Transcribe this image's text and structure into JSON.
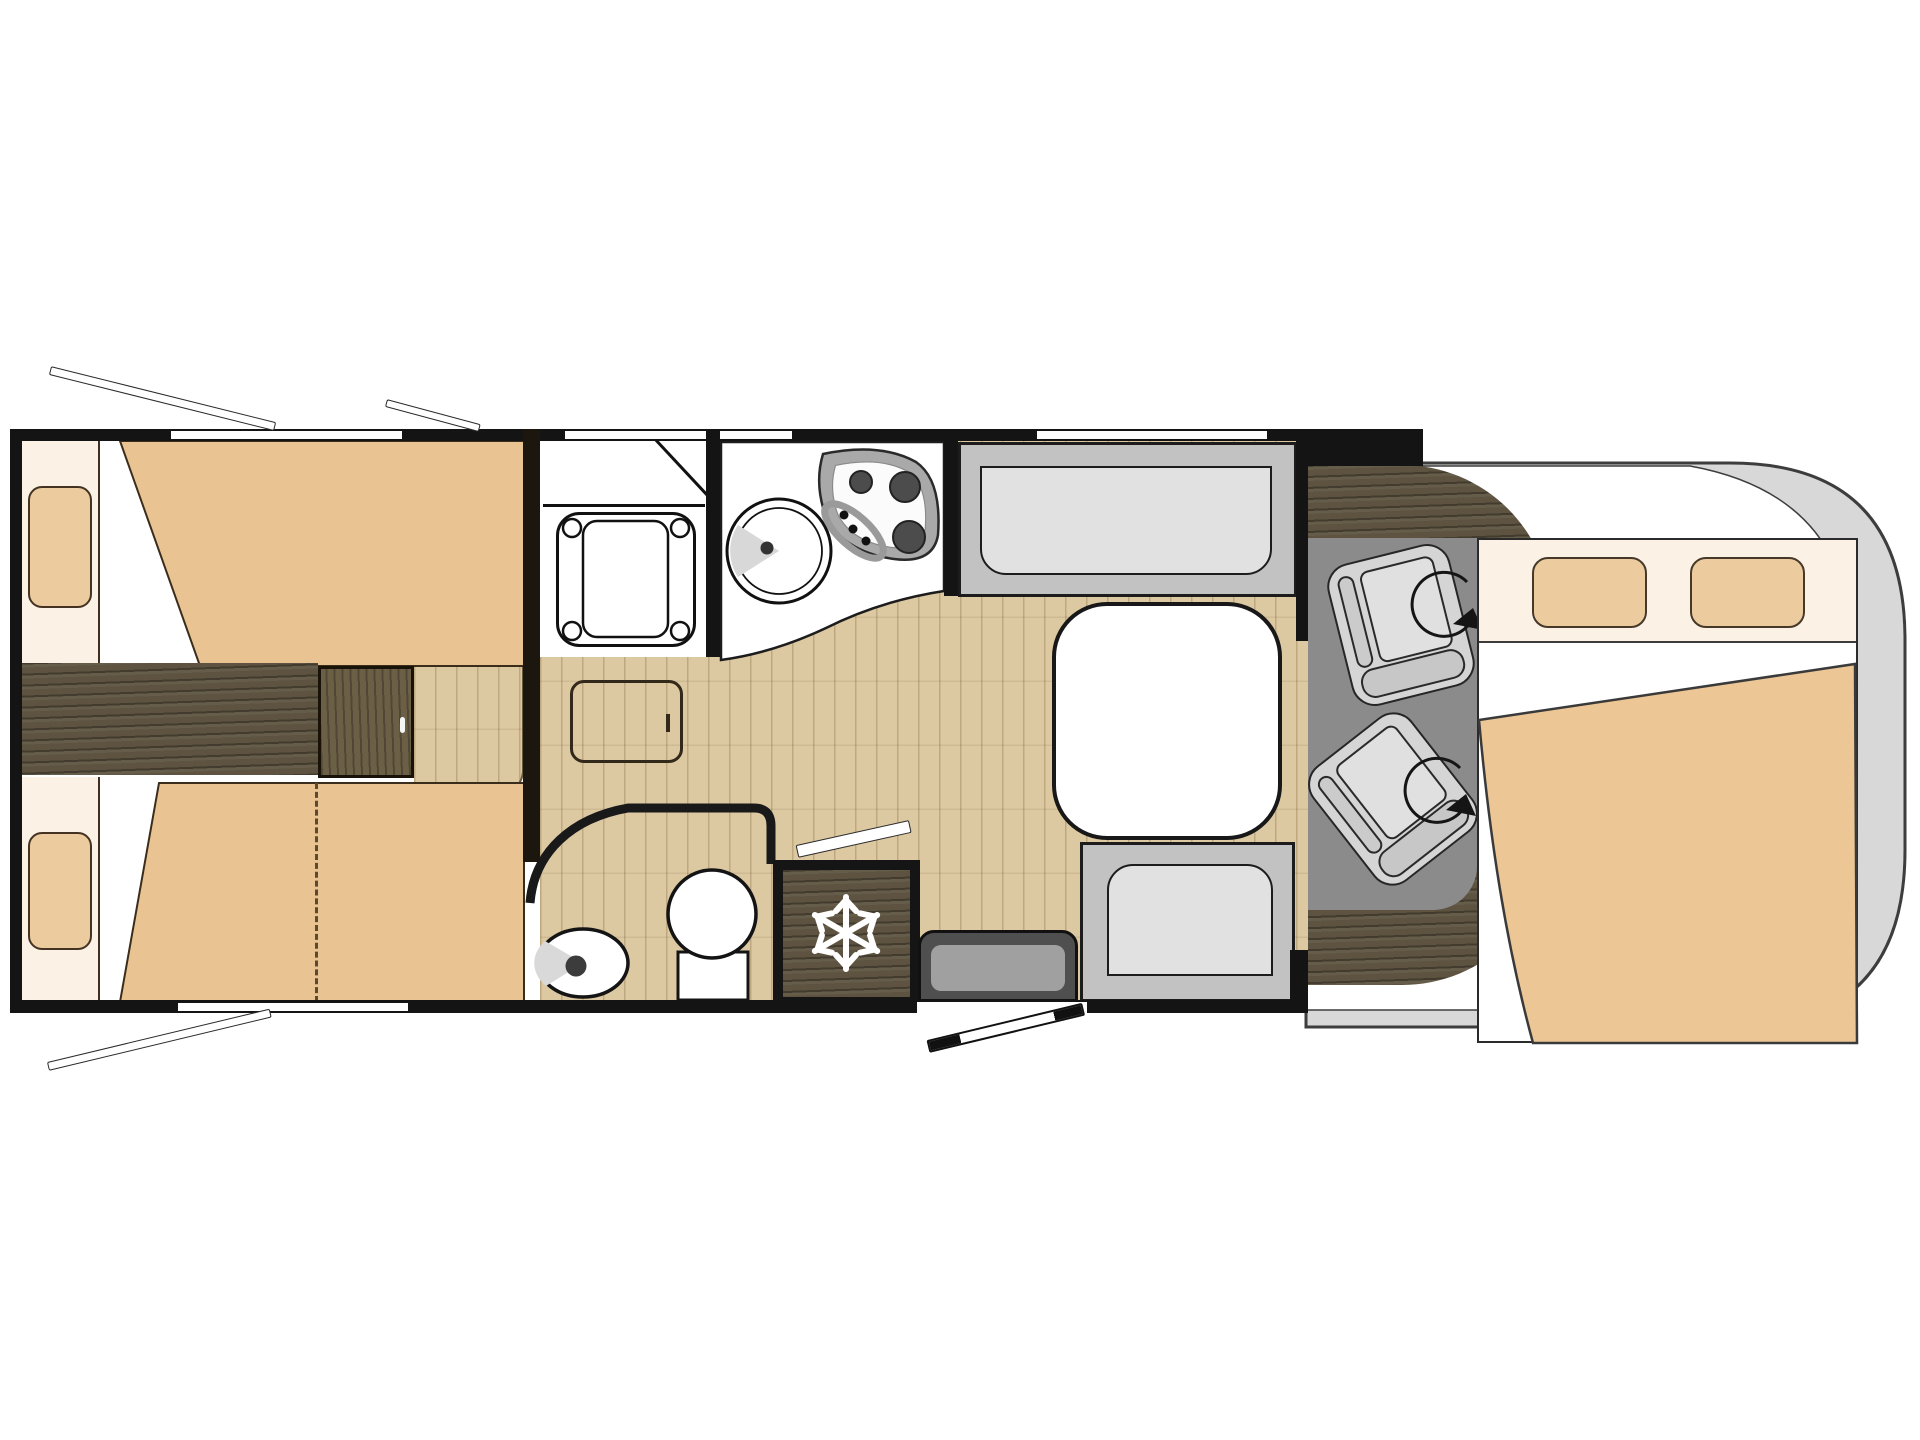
{
  "title": "Motorhome floor plan (top-down diagram, cab on the right, no visible text in image)",
  "colors": {
    "wall": "#141414",
    "outline": "#1c1c1c",
    "wood": "#5d5340",
    "stepwood": "#6b6046",
    "floor": "#dcc9a2",
    "mattress": "#e9c392",
    "pillow": "#eccb9e",
    "cream": "#fbf1e4",
    "duvet": "#ecc795",
    "cabfloor": "#8b8b8b",
    "bodygray": "#d8d8d8",
    "benchframe": "#c2c2c2",
    "benchcushion": "#e1e1e1",
    "seatgray": "#d5d5d5",
    "stepdark": "#4f4f4f",
    "steplight": "#a0a0a0",
    "snow": "#ffffff"
  },
  "icons": [
    {
      "name": "snowflake-icon",
      "meaning": "refrigerator / freezer compartment"
    },
    {
      "name": "swivel-arrow-icon",
      "meaning": "rotating cab seat (driver)"
    },
    {
      "name": "swivel-arrow-icon",
      "meaning": "rotating cab seat (passenger)"
    },
    {
      "name": "burner-icon",
      "meaning": "3-ring gas hob"
    },
    {
      "name": "open-door-icon",
      "meaning": "entry door leaf / fridge door leaf"
    },
    {
      "name": "skylight-icon",
      "meaning": "opened roof vent bars (3)"
    }
  ],
  "elements": {
    "rear_bedroom": [
      "twin-bed-top",
      "twin-bed-bottom",
      "pillows",
      "center-walkway",
      "step-box",
      "bed-extension-dashed-line"
    ],
    "bathroom": [
      "shower-cubicle",
      "shower-tray",
      "floor-hatch",
      "washbasin",
      "toilet",
      "curved-partition-wall"
    ],
    "kitchen": [
      "corner-counter",
      "round-sink",
      "hob-3-burners"
    ],
    "dinette": [
      "long-bench",
      "short-bench",
      "rounded-table"
    ],
    "entry": [
      "entry-step-cabinet",
      "entry-door-open-leaf",
      "fridge-with-snowflake"
    ],
    "cab": [
      "vehicle-body-outline",
      "dashboard-wood-crescent",
      "cab-floor",
      "swivel-seat-1",
      "swivel-seat-2",
      "overcab-bed-with-pillows-and-duvet"
    ],
    "walls": [
      "top-wall-3-windows",
      "bottom-wall-window-and-door-opening",
      "left-wall",
      "partition-walls"
    ]
  },
  "counts": {
    "windows_top": 3,
    "windows_bottom": 1,
    "skylights": 3,
    "seats_swivel": 2,
    "beds": 3,
    "burners": 3
  }
}
